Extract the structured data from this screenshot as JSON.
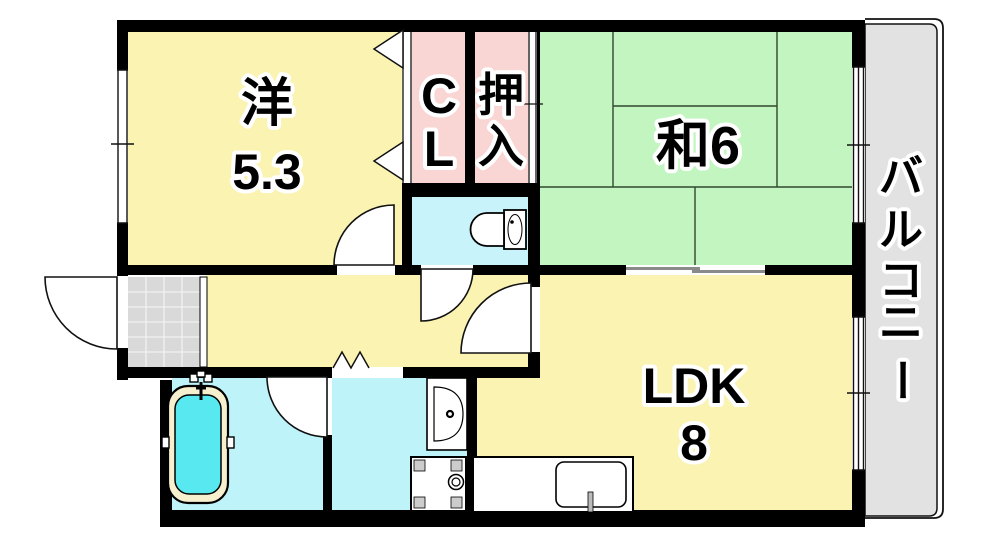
{
  "plan": {
    "title": "1LDK+2 apartment floor plan",
    "rooms": {
      "western": {
        "name": "洋",
        "size": "5.3"
      },
      "closet": {
        "line1": "C",
        "line2": "L"
      },
      "oshiire": {
        "line1": "押",
        "line2": "入"
      },
      "japanese": {
        "label": "和6"
      },
      "ldk": {
        "name": "LDK",
        "size": "8"
      },
      "balcony": {
        "label": "バルコニー",
        "chars": [
          "バ",
          "ル",
          "コ",
          "ニ",
          "ー"
        ]
      }
    },
    "fixtures": [
      "toilet",
      "bathtub",
      "washbasin",
      "washing-machine-pan",
      "kitchen-sink",
      "entrance-tile"
    ],
    "colors": {
      "room_yellow": "#faf3b2",
      "closet_pink": "#f9d6d3",
      "tatami_green": "#c2f5c0",
      "wet_cyan": "#bef4f9",
      "toilet_cyan": "#c9f3fb",
      "bath_water": "#57e8f0",
      "tub_rim": "#f6f0cf",
      "balcony_gray": "#e2e2e2",
      "genkan_tile": "#d9d9d9",
      "wall": "#000000"
    }
  }
}
